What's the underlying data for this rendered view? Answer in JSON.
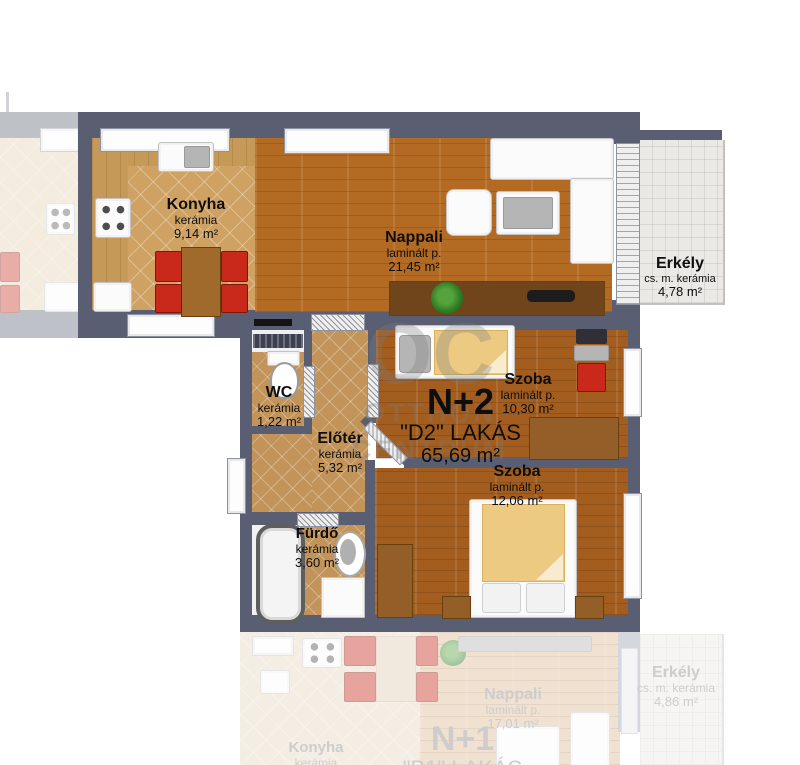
{
  "plan": {
    "unit": {
      "type": "N+2",
      "name": "\"D2\" LAKÁS",
      "area": "65,69 m²"
    },
    "rooms": {
      "konyha": {
        "name": "Konyha",
        "material": "kerámia",
        "area": "9,14 m²"
      },
      "nappali": {
        "name": "Nappali",
        "material": "laminált p.",
        "area": "21,45 m²"
      },
      "erkely": {
        "name": "Erkély",
        "material": "cs. m. kerámia",
        "area": "4,78 m²"
      },
      "wc": {
        "name": "WC",
        "material": "kerámia",
        "area": "1,22 m²"
      },
      "eloter": {
        "name": "Előtér",
        "material": "kerámia",
        "area": "5,32 m²"
      },
      "szoba1": {
        "name": "Szoba",
        "material": "laminált p.",
        "area": "10,30 m²"
      },
      "szoba2": {
        "name": "Szoba",
        "material": "laminált p.",
        "area": "12,06 m²"
      },
      "furdo": {
        "name": "Fürdő",
        "material": "kerámia",
        "area": "3,60 m²"
      }
    }
  },
  "watermark": {
    "line1": "OC",
    "line2": "OTTHON",
    "line3": "CENTRUM"
  },
  "reflection": {
    "unit": {
      "type": "N+1",
      "name": "\"B1\" LAKÁS"
    },
    "rooms": {
      "nappali": {
        "name": "Nappali",
        "material": "laminált p.",
        "area": "17,01 m²"
      },
      "erkely": {
        "name": "Erkély",
        "material": "cs. m. kerámia",
        "area": "4,86 m²"
      },
      "konyha": {
        "name": "Konyha",
        "material": "kerámia"
      }
    }
  },
  "colors": {
    "wall": "#5a5e72",
    "wood_floor": "#b36b23",
    "tile_floor": "#cfa263",
    "balcony_tile": "#eae9e5",
    "furniture_red": "#c8291b",
    "blanket_tan": "#ecca82"
  }
}
